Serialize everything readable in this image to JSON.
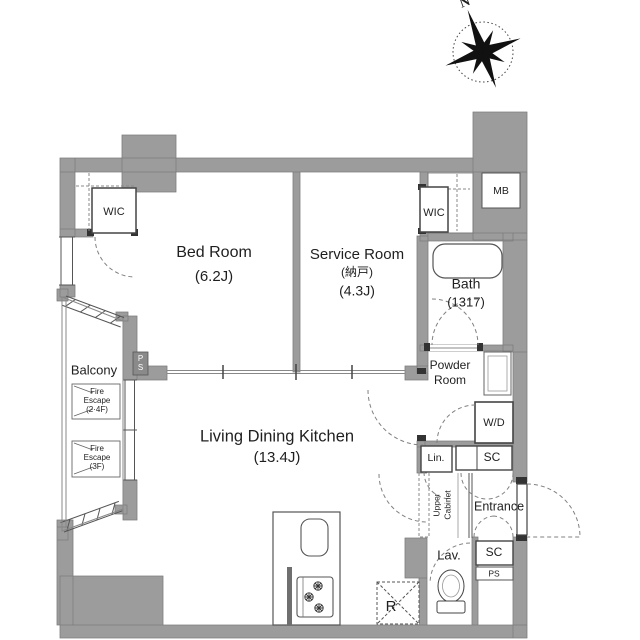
{
  "colors": {
    "wall_gray": "#9c9c9c",
    "wall_dark": "#6f6f6f",
    "line": "#444444",
    "dashed": "#808080",
    "text": "#1f1f1f",
    "background": "#ffffff"
  },
  "compass": {
    "north_label": "N"
  },
  "rooms": {
    "bedroom": {
      "name": "Bed Room",
      "size": "(6.2J)"
    },
    "service_room": {
      "name": "Service Room",
      "name_jp": "(納戸)",
      "size": "(4.3J)"
    },
    "ldk": {
      "name": "Living Dining Kitchen",
      "size": "(13.4J)"
    },
    "bath": {
      "name": "Bath",
      "size": "(1317)"
    },
    "powder_room": {
      "line1": "Powder",
      "line2": "Room"
    },
    "balcony": {
      "name": "Balcony"
    },
    "entrance": {
      "name": "Entrance"
    },
    "lavatory": {
      "name": "Lav."
    }
  },
  "storage": {
    "wic_bedroom": "WIC",
    "wic_service": "WIC",
    "meter_box": "MB",
    "washer_dryer": "W/D",
    "linen": "Lin.",
    "shoe_closet_upper": "SC",
    "shoe_closet_lower": "SC",
    "pipe_shaft_lower": "PS",
    "pipe_shaft_balcony": {
      "char1": "P",
      "char2": "S"
    },
    "upper_cabinet": {
      "line1": "Upper",
      "line2": "Cabinet"
    },
    "refrigerator": "R"
  },
  "balcony_signs": {
    "fire_escape_upper": {
      "line1": "Fire",
      "line2": "Escape",
      "line3": "(2·4F)"
    },
    "fire_escape_lower": {
      "line1": "Fire",
      "line2": "Escape",
      "line3": "(3F)"
    }
  }
}
